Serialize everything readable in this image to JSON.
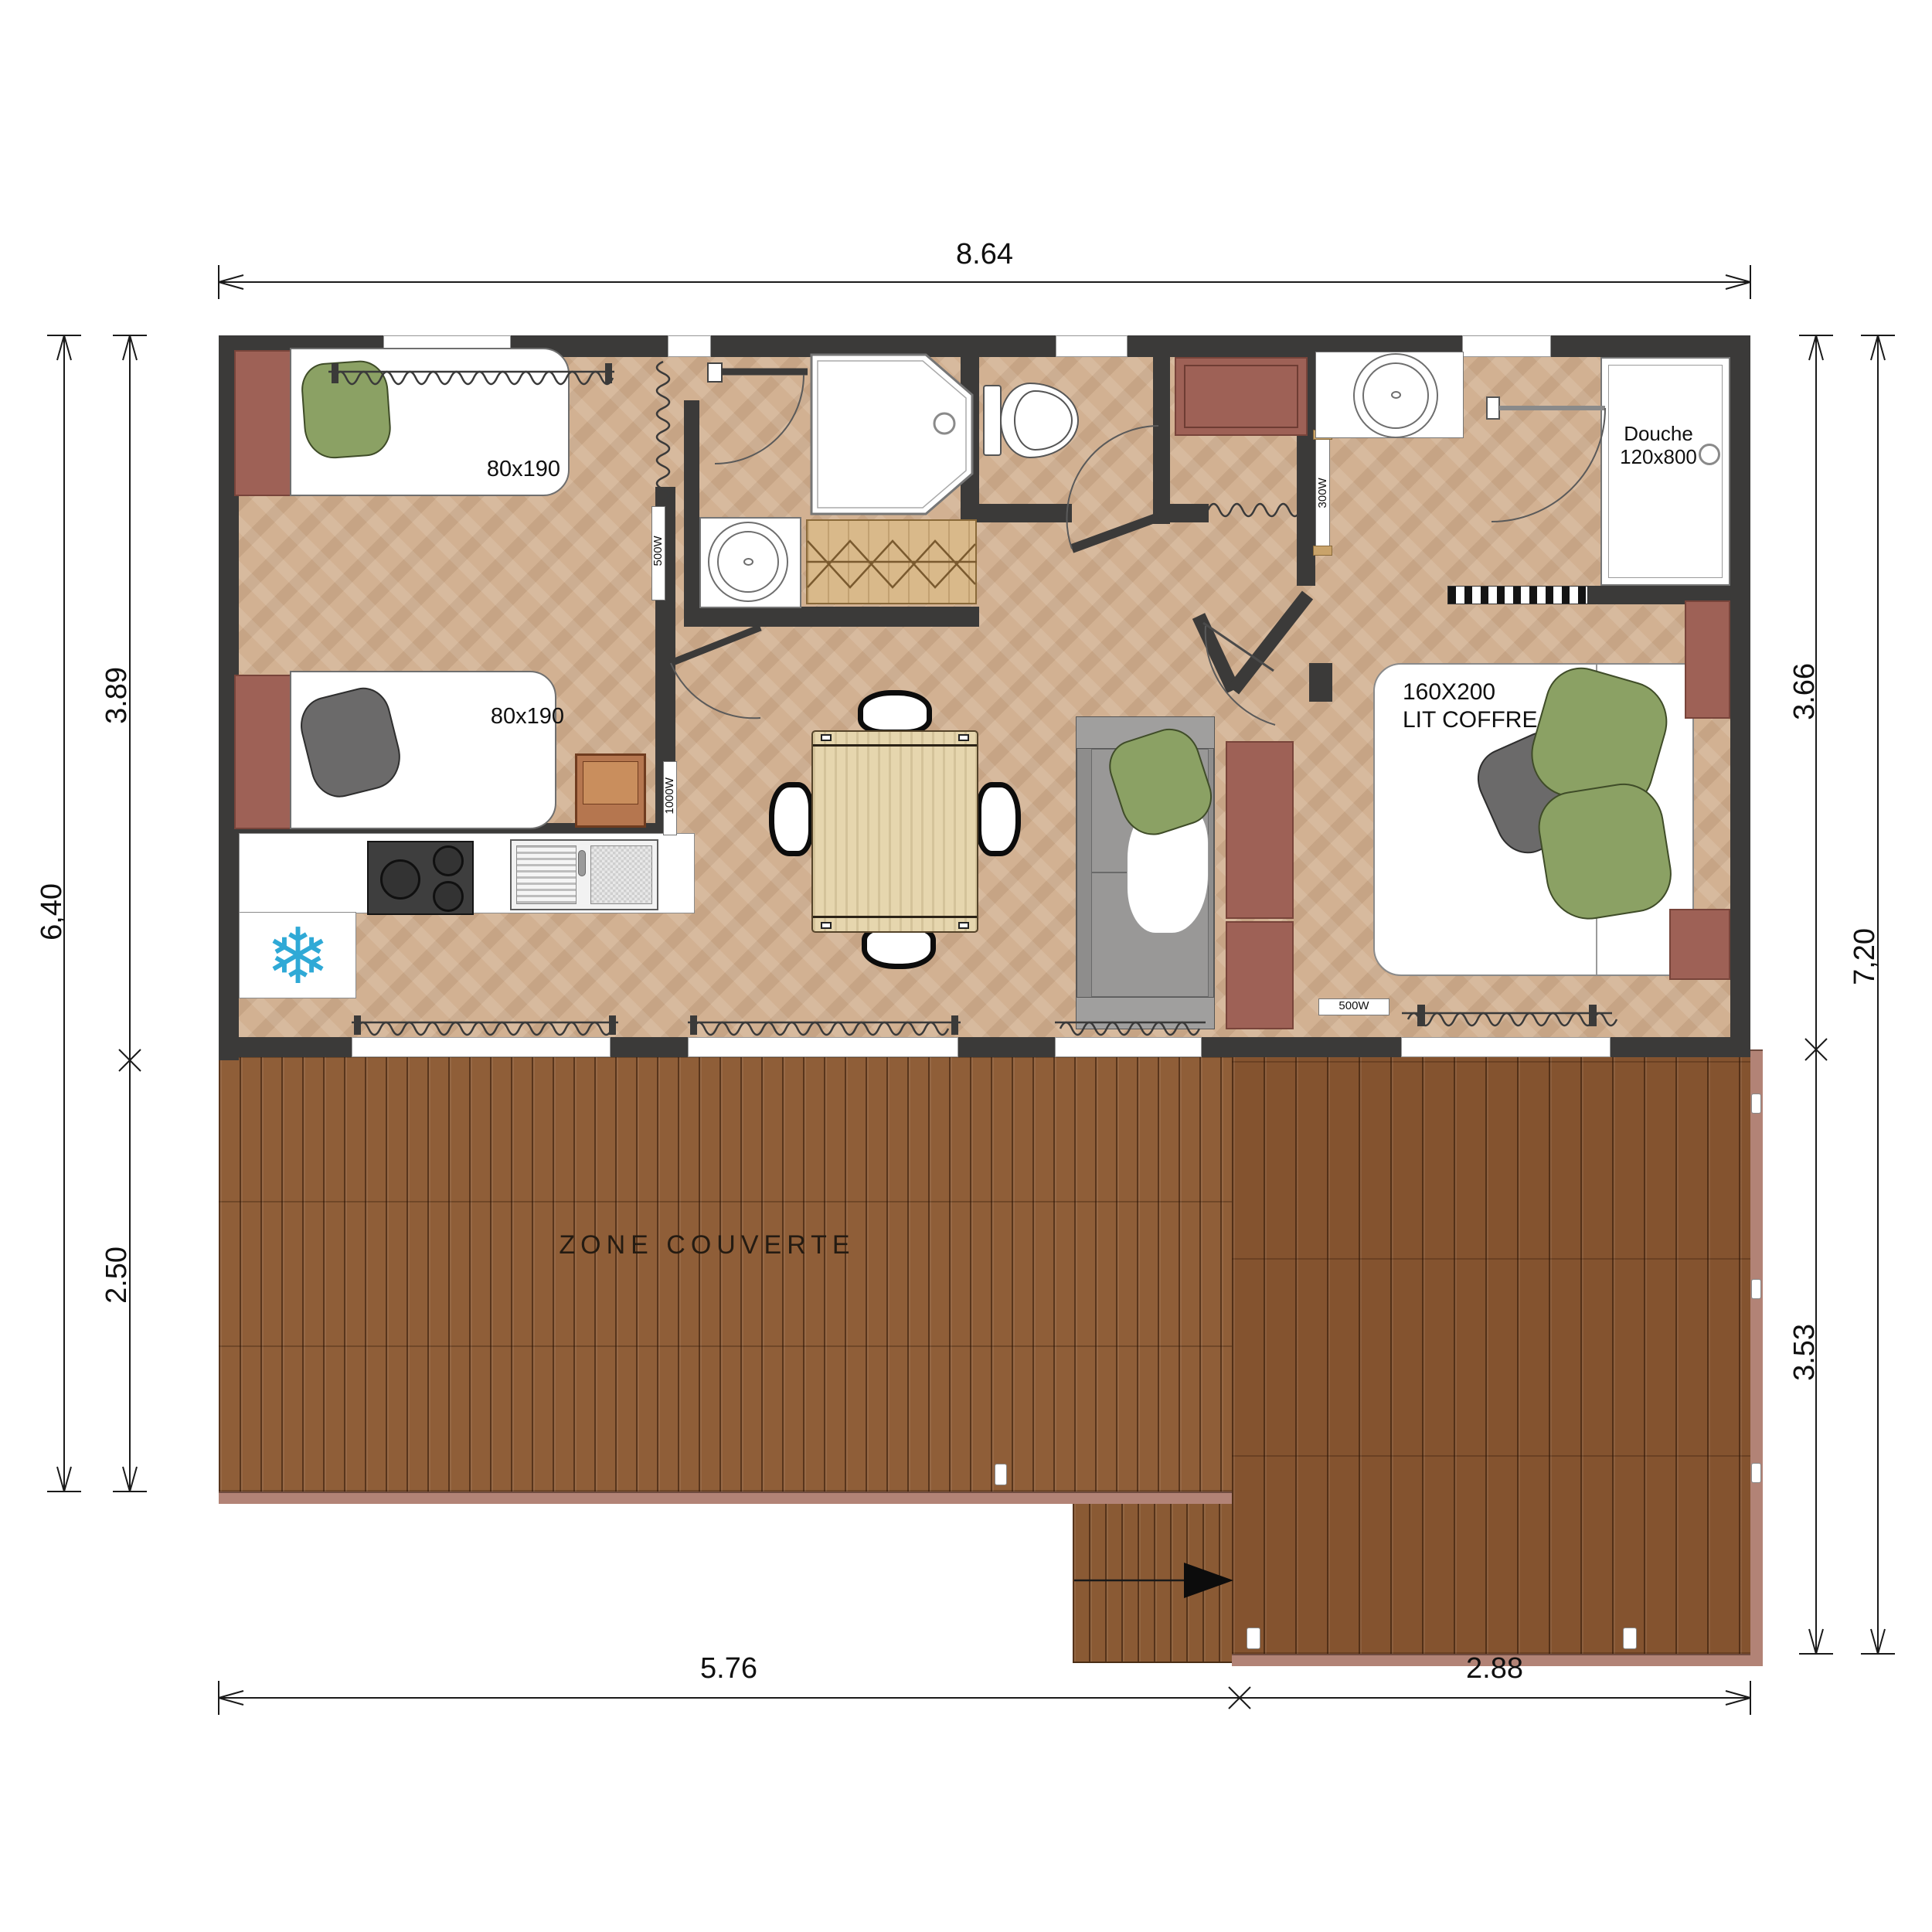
{
  "dimensions": {
    "top": "8.64",
    "left_outer": "6,40",
    "left_inner_top": "3.89",
    "left_inner_bottom": "2.50",
    "right_inner_top": "3.66",
    "right_outer": "7,20",
    "right_inner_bottom": "3.53",
    "bottom_left": "5.76",
    "bottom_right": "2.88"
  },
  "bedroom1": {
    "bed1_size": "80x190",
    "bed2_size": "80x190"
  },
  "bathroom1": {
    "shower_name": "Douche",
    "shower_size": "800x800",
    "heater": "500W"
  },
  "hall": {
    "heater": "1000W"
  },
  "entry": {
    "heater": "300W"
  },
  "bathroom2": {
    "shower_name": "Douche",
    "shower_size": "120x800"
  },
  "bedroom2": {
    "bed_size": "160X200",
    "bed_type": "LIT COFFRE",
    "heater": "500W"
  },
  "terrace": {
    "label": "ZONE COUVERTE"
  },
  "icons": {
    "snowflake": "❄"
  },
  "colors": {
    "wall": "#3b3a39",
    "floor": "#d2b192",
    "deck": "#8a5a34",
    "deck_edge": "#b28376",
    "maroon": "#9e6156",
    "pillow_green": "#8ba164",
    "sofa_gray": "#8e8d8c",
    "snowflake_blue": "#2fa9d6",
    "table_wood": "#e6d6ae"
  }
}
